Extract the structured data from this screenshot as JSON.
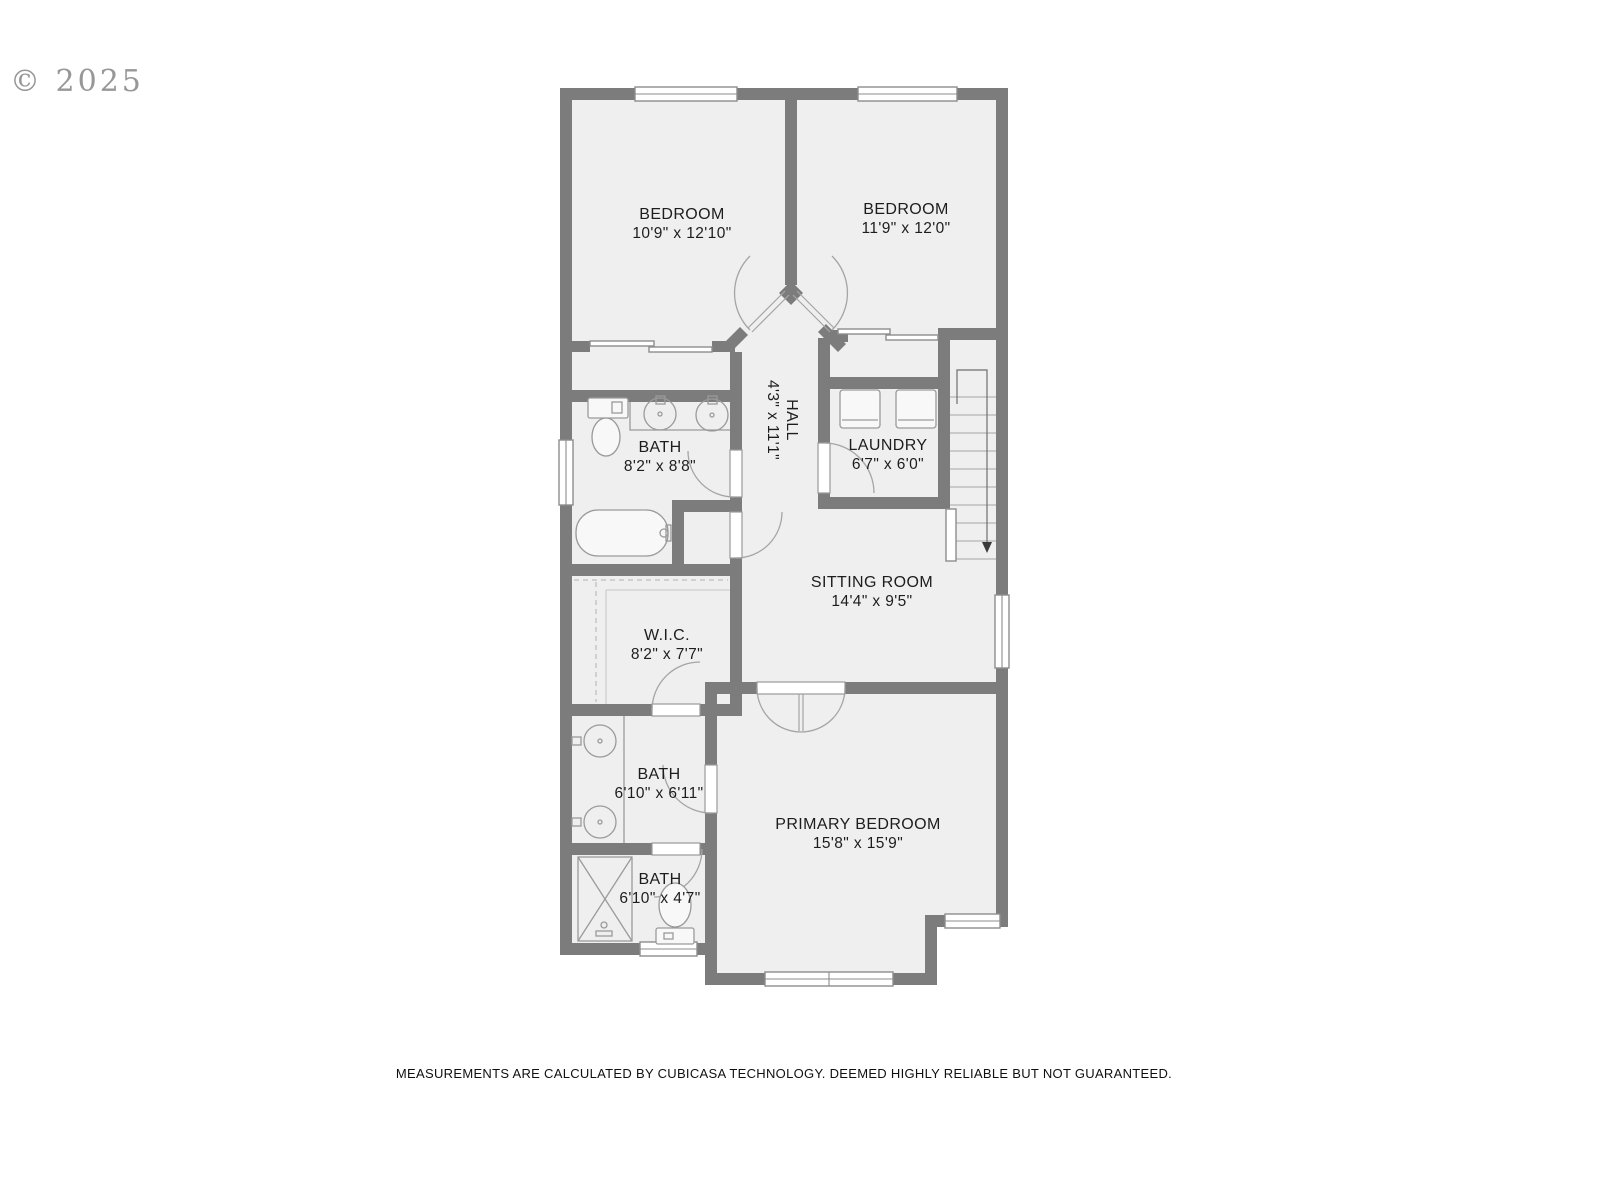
{
  "watermark": "© 2025",
  "footer": "MEASUREMENTS ARE CALCULATED BY CUBICASA TECHNOLOGY. DEEMED HIGHLY RELIABLE BUT NOT GUARANTEED.",
  "rooms": {
    "bedroom1": {
      "name": "BEDROOM",
      "dims": "10'9\" x 12'10\""
    },
    "bedroom2": {
      "name": "BEDROOM",
      "dims": "11'9\" x 12'0\""
    },
    "bath1": {
      "name": "BATH",
      "dims": "8'2\" x 8'8\""
    },
    "hall": {
      "name": "HALL",
      "dims": "4'3\" x 11'1\""
    },
    "laundry": {
      "name": "LAUNDRY",
      "dims": "6'7\" x 6'0\""
    },
    "sitting": {
      "name": "SITTING ROOM",
      "dims": "14'4\" x 9'5\""
    },
    "wic": {
      "name": "W.I.C.",
      "dims": "8'2\" x 7'7\""
    },
    "bath2": {
      "name": "BATH",
      "dims": "6'10\" x 6'11\""
    },
    "bath3": {
      "name": "BATH",
      "dims": "6'10\" x 4'7\""
    },
    "primary": {
      "name": "PRIMARY BEDROOM",
      "dims": "15'8\" x 15'9\""
    }
  },
  "stairs": {
    "direction": "down"
  },
  "colors": {
    "wall": "#7c7c7c",
    "floor": "#efefef",
    "fixture": "#9a9a9a",
    "label": "#1d1d1d",
    "watermark": "#8f8f8f",
    "background": "#ffffff"
  }
}
